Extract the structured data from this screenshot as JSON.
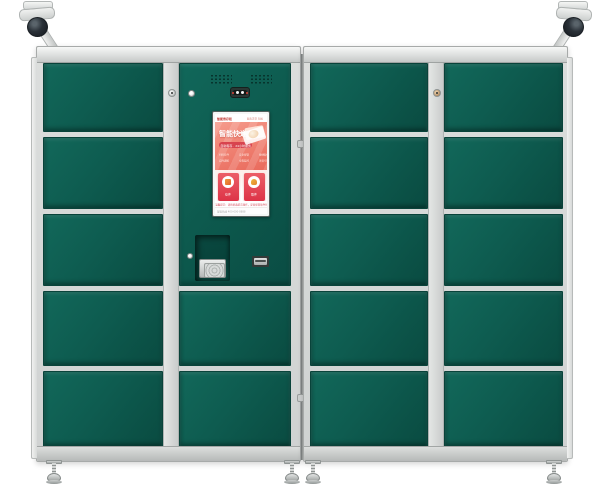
{
  "colors": {
    "door_green": "#0d5a4f",
    "frame_silver": "#d3d6d5",
    "screen_salmon": "#ee7063",
    "card_red": "#e23c4e",
    "camera_dome": "#1c2227",
    "background": "#ffffff"
  },
  "hardware": {
    "left_cabinet_door_count": 7,
    "right_cabinet_door_count": 10,
    "dome_camera_count": 2,
    "leveling_feet_count": 4
  },
  "screen": {
    "header": {
      "brand": "智能寄存柜",
      "status": "服务正常 在线"
    },
    "hero": {
      "title": "智能快递",
      "banner": "自助寄存 · 24小时服务",
      "features": [
        "扫码存件",
        "安全保管",
        "便捷取件",
        "实时通知",
        "全程监控",
        "语音引导"
      ]
    },
    "cards": [
      {
        "label": "存件",
        "icon": "deposit-box-icon"
      },
      {
        "label": "取件",
        "icon": "pickup-bag-icon"
      }
    ],
    "notice": "温馨提示：请按屏幕提示操作，妥善保管取件码",
    "footer": {
      "left": "客服热线 400-000-8888",
      "right": "V1.0"
    }
  }
}
